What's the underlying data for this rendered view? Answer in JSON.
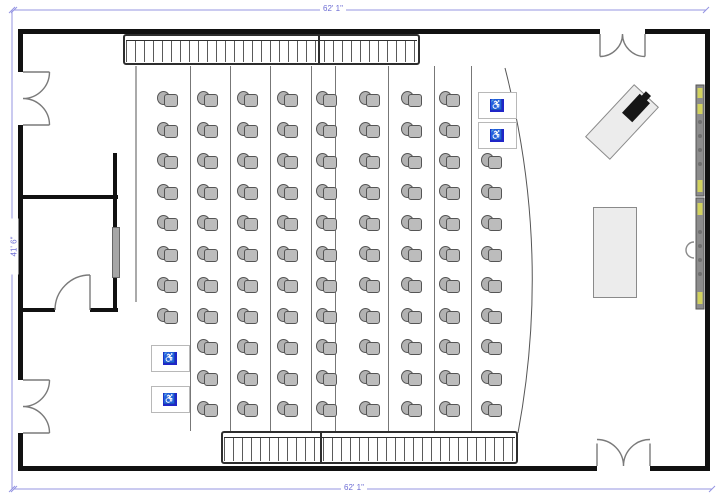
{
  "diagram": {
    "kind": "lecture-hall-floor-plan",
    "canvas": {
      "width": 720,
      "height": 499
    }
  },
  "dimensions": {
    "top": "62' 1\"",
    "bottom": "62' 1\"",
    "left": "41' 6\""
  },
  "colors": {
    "wall": "#111111",
    "dimension_line": "#9494e2",
    "dimension_text": "#6d6dd4",
    "chair_fill": "#b2b2b2",
    "chair_stroke": "#555555",
    "wheelchair_blue": "#1f25c8",
    "screen_bar": "#8c8c8c",
    "screen_bracket": "#d2d25e",
    "furniture_fill": "#ececec"
  },
  "icons": {
    "wheelchair": "♿"
  },
  "seating": {
    "row_ys": [
      100,
      131,
      162,
      193,
      224,
      255,
      286,
      317,
      348,
      379,
      410
    ],
    "columns": [
      {
        "x": 168,
        "row_start": 0,
        "row_count": 8
      },
      {
        "x": 208,
        "row_start": 0,
        "row_count": 11
      },
      {
        "x": 248,
        "row_start": 0,
        "row_count": 11
      },
      {
        "x": 288,
        "row_start": 0,
        "row_count": 11
      },
      {
        "x": 327,
        "row_start": 0,
        "row_count": 11
      },
      {
        "x": 370,
        "row_start": 0,
        "row_count": 11
      },
      {
        "x": 412,
        "row_start": 0,
        "row_count": 11
      },
      {
        "x": 450,
        "row_start": 0,
        "row_count": 11
      },
      {
        "x": 492,
        "row_start": 2,
        "row_count": 9
      }
    ],
    "chair_count": 94,
    "wheelchair_spaces": [
      {
        "x": 169,
        "y": 357
      },
      {
        "x": 169,
        "y": 398
      },
      {
        "x": 496,
        "y": 104
      },
      {
        "x": 496,
        "y": 134
      }
    ],
    "aisle_lines_x": [
      190,
      230,
      270,
      311,
      335,
      388,
      434,
      471
    ],
    "aisle_top": 66,
    "aisle_bottom": 431
  }
}
